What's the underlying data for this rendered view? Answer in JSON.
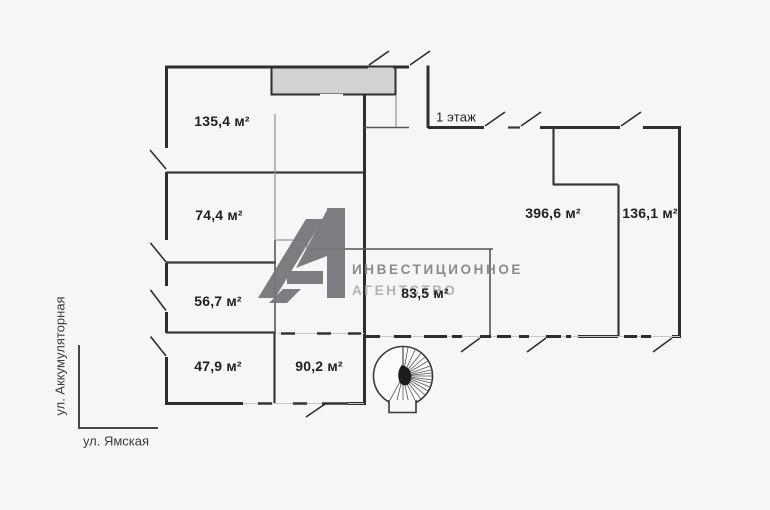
{
  "plan": {
    "floor_label": "1 этаж",
    "rooms": [
      {
        "id": "room-135-4",
        "area": "135,4 м²"
      },
      {
        "id": "room-74-4",
        "area": "74,4 м²"
      },
      {
        "id": "room-56-7",
        "area": "56,7 м²"
      },
      {
        "id": "room-47-9",
        "area": "47,9 м²"
      },
      {
        "id": "room-90-2",
        "area": "90,2 м²"
      },
      {
        "id": "room-83-5",
        "area": "83,5 м²"
      },
      {
        "id": "room-396-6",
        "area": "396,6 м²"
      },
      {
        "id": "room-136-1",
        "area": "136,1 м²"
      }
    ],
    "streets": {
      "vertical": "ул. Аккумуляторная",
      "horizontal": "ул. Ямская"
    },
    "watermark": {
      "line1": "ИНВЕСТИЦИОННОЕ",
      "line2": "АГЕНТСТВО",
      "logo": "a1-triangle-logo"
    },
    "colors": {
      "background": "#f6f6f7",
      "wall": "#2e2e30",
      "wall_light": "#8a8a8e",
      "block_fill": "#d2d2d4",
      "label_text": "#1f1f21",
      "watermark_primary": "#8a8a8e",
      "watermark_secondary": "#b2b2b6",
      "logo_gray": "#77777b"
    }
  }
}
